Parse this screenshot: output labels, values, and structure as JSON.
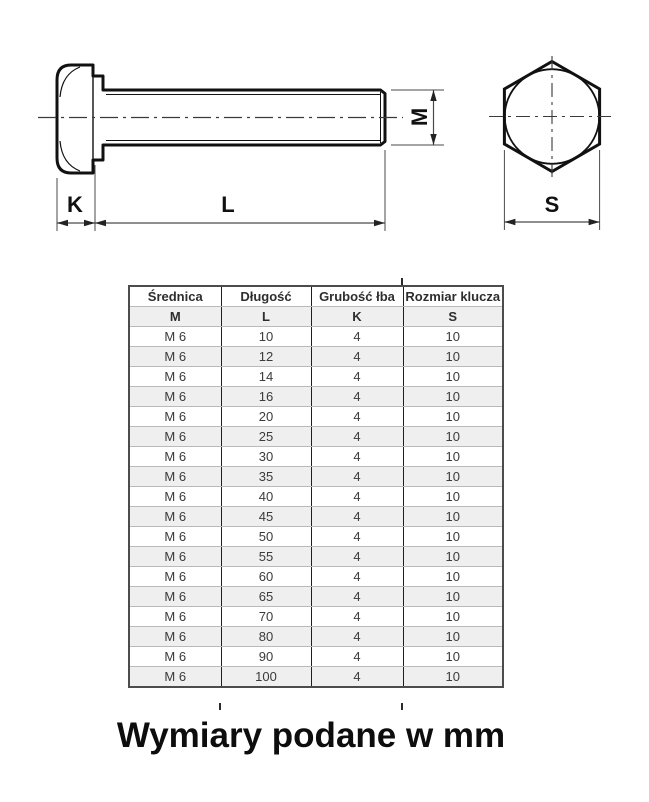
{
  "drawing": {
    "side_view": {
      "k_label": "K",
      "l_label": "L",
      "m_label": "M"
    },
    "front_view": {
      "s_label": "S"
    }
  },
  "table": {
    "header_row": [
      "Średnica",
      "Długość",
      "Grubość łba",
      "Rozmiar klucza"
    ],
    "symbol_row": [
      "M",
      "L",
      "K",
      "S"
    ],
    "rows": [
      [
        "M 6",
        "10",
        "4",
        "10"
      ],
      [
        "M 6",
        "12",
        "4",
        "10"
      ],
      [
        "M 6",
        "14",
        "4",
        "10"
      ],
      [
        "M 6",
        "16",
        "4",
        "10"
      ],
      [
        "M 6",
        "20",
        "4",
        "10"
      ],
      [
        "M 6",
        "25",
        "4",
        "10"
      ],
      [
        "M 6",
        "30",
        "4",
        "10"
      ],
      [
        "M 6",
        "35",
        "4",
        "10"
      ],
      [
        "M 6",
        "40",
        "4",
        "10"
      ],
      [
        "M 6",
        "45",
        "4",
        "10"
      ],
      [
        "M 6",
        "50",
        "4",
        "10"
      ],
      [
        "M 6",
        "55",
        "4",
        "10"
      ],
      [
        "M 6",
        "60",
        "4",
        "10"
      ],
      [
        "M 6",
        "65",
        "4",
        "10"
      ],
      [
        "M 6",
        "70",
        "4",
        "10"
      ],
      [
        "M 6",
        "80",
        "4",
        "10"
      ],
      [
        "M 6",
        "90",
        "4",
        "10"
      ],
      [
        "M 6",
        "100",
        "4",
        "10"
      ]
    ]
  },
  "caption": "Wymiary podane w mm",
  "colors": {
    "outline": "#111111",
    "thin_line": "#4a4a4a",
    "centerline": "#3a3a3a",
    "table_outer_border": "#4c4c4c",
    "table_column_line": "#1f1f1f",
    "table_row_line": "#bababa",
    "row_alt_bg": "#efefef",
    "table_text": "#3b3b3b"
  }
}
